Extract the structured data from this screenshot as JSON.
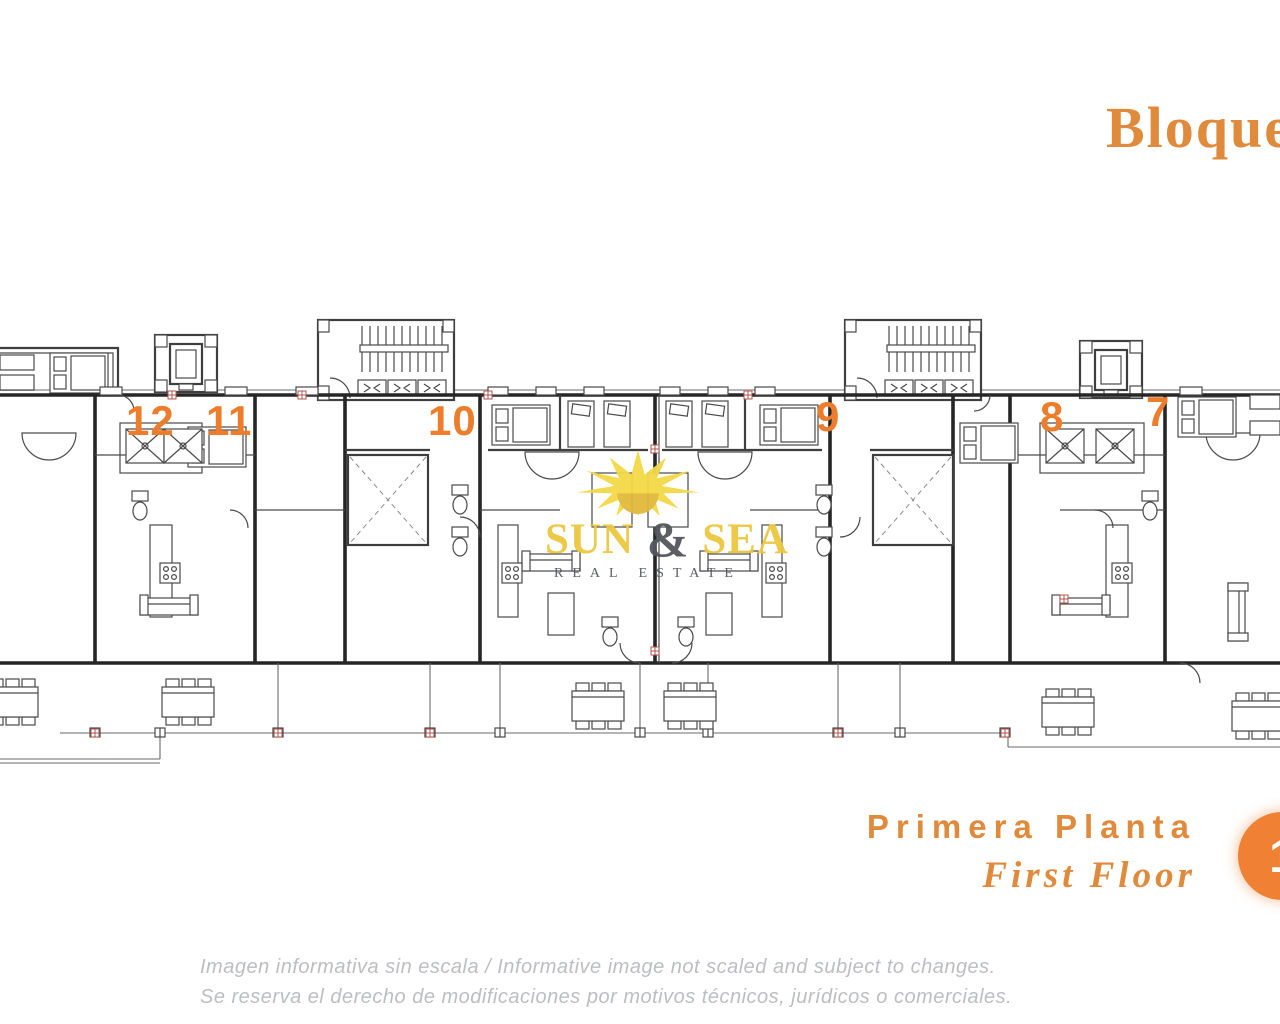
{
  "header": {
    "block_title": "Bloque"
  },
  "plan": {
    "unit_numbers": [
      "12",
      "11",
      "10",
      "9",
      "8",
      "7"
    ]
  },
  "watermark": {
    "word_left": "SUN",
    "ampersand": "&",
    "word_right": "SEA",
    "tagline": "REAL ESTATE"
  },
  "floor_label": {
    "spanish": "Primera Planta",
    "english": "First Floor",
    "badge_number": "1"
  },
  "disclaimer": {
    "line1": "Imagen informativa sin escala /  Informative image not scaled and subject to changes.",
    "line2": "Se reserva el derecho de modificaciones por motivos técnicos, jurídicos o comerciales."
  },
  "colors": {
    "accent_orange": "#E08A3C",
    "unit_number_orange": "#ED7C2B",
    "badge_orange": "#F08134",
    "sun_yellow": "#F3D946",
    "logo_gold": "#ECC73E",
    "logo_gray": "#53565A",
    "plan_line_dark": "#3E3E3E",
    "plan_line_light": "#B5B5B5",
    "disclaimer_gray": "#BCBEC1"
  }
}
